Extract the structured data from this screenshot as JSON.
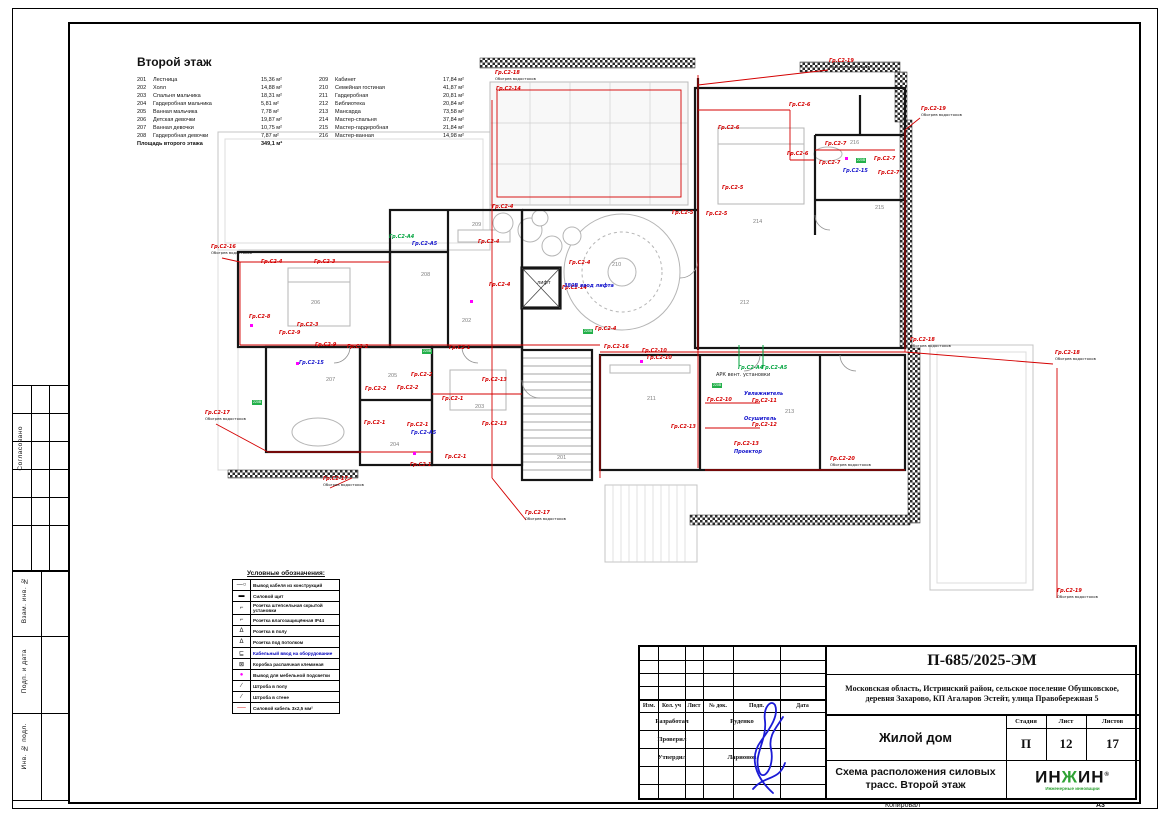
{
  "page": {
    "copied_label": "Копировал",
    "format_label": "А3"
  },
  "left_margin": {
    "approved": "Согласовано",
    "vzam": "Взам. инв. №",
    "podp": "Подп. и дата",
    "inv": "Инв. № подл."
  },
  "room_schedule": {
    "title": "Второй этаж",
    "col1": [
      {
        "num": "201",
        "name": "Лестница",
        "area": "15,36 м²"
      },
      {
        "num": "202",
        "name": "Холл",
        "area": "14,88 м²"
      },
      {
        "num": "203",
        "name": "Спальня мальчика",
        "area": "18,31 м²"
      },
      {
        "num": "204",
        "name": "Гардеробная мальчика",
        "area": "5,81 м²"
      },
      {
        "num": "205",
        "name": "Ванная мальчика",
        "area": "7,78 м²"
      },
      {
        "num": "206",
        "name": "Детская девочки",
        "area": "19,87 м²"
      },
      {
        "num": "207",
        "name": "Ванная девочки",
        "area": "10,75 м²"
      },
      {
        "num": "208",
        "name": "Гардеробная девочки",
        "area": "7,87 м²"
      }
    ],
    "col2": [
      {
        "num": "209",
        "name": "Кабинет",
        "area": "17,84 м²"
      },
      {
        "num": "210",
        "name": "Семейная гостиная",
        "area": "41,87 м²"
      },
      {
        "num": "211",
        "name": "Гардеробная",
        "area": "20,81 м²"
      },
      {
        "num": "212",
        "name": "Библиотека",
        "area": "20,84 м²"
      },
      {
        "num": "213",
        "name": "Мансарда",
        "area": "73,58 м²"
      },
      {
        "num": "214",
        "name": "Мастер-спальня",
        "area": "37,84 м²"
      },
      {
        "num": "215",
        "name": "Мастер-гардеробная",
        "area": "21,84 м²"
      },
      {
        "num": "216",
        "name": "Мастер-ванная",
        "area": "14,98 м²"
      }
    ],
    "total_label": "Площадь второго этажа",
    "total_area": "349,1 м²"
  },
  "legend": {
    "title": "Условные обозначения:",
    "items": [
      {
        "symbol": "wire-exit",
        "label": "Вывод кабеля из конструкций"
      },
      {
        "symbol": "panel",
        "label": "Силовой щит"
      },
      {
        "symbol": "socket",
        "label": "Розетка штепсельная скрытой установки"
      },
      {
        "symbol": "socket-wet",
        "label": "Розетка влагозащищённая IP44"
      },
      {
        "symbol": "socket-floor",
        "label": "Розетка в полу"
      },
      {
        "symbol": "socket-ceiling",
        "label": "Розетка под потолком"
      },
      {
        "symbol": "equipment",
        "label": "Кабельный ввод на оборудование",
        "accent": "blue"
      },
      {
        "symbol": "junction",
        "label": "Коробка распаячная клеммная"
      },
      {
        "symbol": "furniture",
        "label": "Вывод для мебельной подсветки"
      },
      {
        "symbol": "chase-floor",
        "label": "Штроба в полу"
      },
      {
        "symbol": "chase-wall",
        "label": "Штроба в стене"
      },
      {
        "symbol": "cable",
        "label": "Силовой кабель 3х2,5 мм²"
      }
    ]
  },
  "title_block": {
    "doc_number": "П-685/2025-ЭМ",
    "address": "Московская область, Истринский район, сельское поселение Обушковское, деревня Захарово, КП Агаларов Эстейт, улица Правобережная 5",
    "object_name": "Жилой дом",
    "sheet_title": "Схема расположения силовых трасс. Второй этаж",
    "stage_label": "Стадия",
    "sheet_label": "Лист",
    "sheets_label": "Листов",
    "stage": "П",
    "sheet": "12",
    "sheets": "17",
    "header_cols": [
      "Изм.",
      "Кол. уч",
      "Лист",
      "№ док.",
      "Подп.",
      "Дата"
    ],
    "rows": [
      {
        "role": "Разработал",
        "name": "Руденко"
      },
      {
        "role": "Проверил",
        "name": ""
      },
      {
        "role": "Утвердил",
        "name": "Ларионов"
      }
    ],
    "logo_part1": "ИН",
    "logo_accent": "Ж",
    "logo_part2": "ИН",
    "logo_reg": "®",
    "logo_sub": "Инженерные инновации"
  },
  "plan": {
    "accent_colors": {
      "circuit": "#d40000",
      "device": "#1414cc",
      "auto": "#00a33e",
      "outlet_marker": "#ff00ff"
    },
    "rooms": [
      {
        "n": "201",
        "x": 357,
        "y": 405
      },
      {
        "n": "202",
        "x": 262,
        "y": 268
      },
      {
        "n": "203",
        "x": 275,
        "y": 354
      },
      {
        "n": "204",
        "x": 190,
        "y": 392
      },
      {
        "n": "205",
        "x": 188,
        "y": 323
      },
      {
        "n": "206",
        "x": 111,
        "y": 250
      },
      {
        "n": "207",
        "x": 126,
        "y": 327
      },
      {
        "n": "208",
        "x": 221,
        "y": 222
      },
      {
        "n": "209",
        "x": 272,
        "y": 172
      },
      {
        "n": "210",
        "x": 412,
        "y": 212
      },
      {
        "n": "211",
        "x": 447,
        "y": 346
      },
      {
        "n": "212",
        "x": 540,
        "y": 250
      },
      {
        "n": "213",
        "x": 585,
        "y": 359
      },
      {
        "n": "214",
        "x": 553,
        "y": 169
      },
      {
        "n": "215",
        "x": 675,
        "y": 155
      },
      {
        "n": "216",
        "x": 650,
        "y": 90
      }
    ],
    "labels": [
      {
        "x": 296,
        "y": 26,
        "t": "Гр.С2-18",
        "sub": "Обогрев водостоков"
      },
      {
        "x": 630,
        "y": 14,
        "t": "Гр.С2-19",
        "sub": "Обогрев водостоков"
      },
      {
        "x": 722,
        "y": 62,
        "t": "Гр.С2-19",
        "sub": "Обогрев водостоков"
      },
      {
        "x": 856,
        "y": 306,
        "t": "Гр.С2-18",
        "sub": "Обогрев водостоков"
      },
      {
        "x": 858,
        "y": 544,
        "t": "Гр.С2-19",
        "sub": "Обогрев водостоков"
      },
      {
        "x": 711,
        "y": 293,
        "t": "Гр.С2-18",
        "sub": "Обогрев водостоков"
      },
      {
        "x": 326,
        "y": 466,
        "t": "Гр.С2-17",
        "sub": "Обогрев водостоков"
      },
      {
        "x": 124,
        "y": 432,
        "t": "Гр.С2-17",
        "sub": "Обогрев водостоков"
      },
      {
        "x": 6,
        "y": 366,
        "t": "Гр.С2-17",
        "sub": "Обогрев водостоков"
      },
      {
        "x": 12,
        "y": 200,
        "t": "Гр.С2-16",
        "sub": "Обогрев водостоков"
      },
      {
        "x": 631,
        "y": 412,
        "t": "Гр.С2-20",
        "sub": "Обогрев водостоков"
      },
      {
        "x": 297,
        "y": 42,
        "t": "Гр.С2-14"
      },
      {
        "x": 62,
        "y": 215,
        "t": "Гр.С2-4"
      },
      {
        "x": 115,
        "y": 215,
        "t": "Гр.С2-3"
      },
      {
        "x": 50,
        "y": 270,
        "t": "Гр.С2-8"
      },
      {
        "x": 98,
        "y": 278,
        "t": "Гр.С2-3"
      },
      {
        "x": 116,
        "y": 298,
        "t": "Гр.С2-9"
      },
      {
        "x": 80,
        "y": 286,
        "t": "Гр.С2-9"
      },
      {
        "x": 148,
        "y": 300,
        "t": "Гр.С2-2"
      },
      {
        "x": 250,
        "y": 301,
        "t": "Гр.С2-1"
      },
      {
        "x": 166,
        "y": 342,
        "t": "Гр.С2-2"
      },
      {
        "x": 198,
        "y": 341,
        "t": "Гр.С2-2"
      },
      {
        "x": 212,
        "y": 328,
        "t": "Гр.С2-2"
      },
      {
        "x": 165,
        "y": 376,
        "t": "Гр.С2-1"
      },
      {
        "x": 208,
        "y": 378,
        "t": "Гр.С2-1"
      },
      {
        "x": 243,
        "y": 352,
        "t": "Гр.С2-1"
      },
      {
        "x": 283,
        "y": 333,
        "t": "Гр.С2-13"
      },
      {
        "x": 283,
        "y": 377,
        "t": "Гр.С2-13"
      },
      {
        "x": 246,
        "y": 410,
        "t": "Гр.С2-1"
      },
      {
        "x": 211,
        "y": 418,
        "t": "Гр.С2-1"
      },
      {
        "x": 293,
        "y": 160,
        "t": "Гр.С2-4"
      },
      {
        "x": 279,
        "y": 195,
        "t": "Гр.С2-4"
      },
      {
        "x": 290,
        "y": 238,
        "t": "Гр.С2-4"
      },
      {
        "x": 370,
        "y": 216,
        "t": "Гр.С2-4"
      },
      {
        "x": 363,
        "y": 241,
        "t": "Гр.С2-14"
      },
      {
        "x": 396,
        "y": 282,
        "t": "Гр.С2-4"
      },
      {
        "x": 405,
        "y": 300,
        "t": "Гр.С2-16"
      },
      {
        "x": 443,
        "y": 304,
        "t": "Гр.С2-10"
      },
      {
        "x": 473,
        "y": 166,
        "t": "Гр.С2-5"
      },
      {
        "x": 448,
        "y": 311,
        "t": "Гр.С2-10"
      },
      {
        "x": 508,
        "y": 353,
        "t": "Гр.С2-10"
      },
      {
        "x": 553,
        "y": 354,
        "t": "Гр.С2-11"
      },
      {
        "x": 553,
        "y": 378,
        "t": "Гр.С2-12"
      },
      {
        "x": 472,
        "y": 380,
        "t": "Гр.С2-13"
      },
      {
        "x": 535,
        "y": 397,
        "t": "Гр.С2-13"
      },
      {
        "x": 590,
        "y": 58,
        "t": "Гр.С2-6"
      },
      {
        "x": 519,
        "y": 81,
        "t": "Гр.С2-6"
      },
      {
        "x": 588,
        "y": 107,
        "t": "Гр.С2-6"
      },
      {
        "x": 626,
        "y": 97,
        "t": "Гр.С2-7"
      },
      {
        "x": 620,
        "y": 116,
        "t": "Гр.С2-7"
      },
      {
        "x": 675,
        "y": 112,
        "t": "Гр.С2-7"
      },
      {
        "x": 679,
        "y": 126,
        "t": "Гр.С2-7"
      },
      {
        "x": 523,
        "y": 141,
        "t": "Гр.С2-5"
      },
      {
        "x": 507,
        "y": 167,
        "t": "Гр.С2-5"
      },
      {
        "x": 644,
        "y": 124,
        "t": "Гр.С2-15",
        "c": "blue"
      },
      {
        "x": 212,
        "y": 386,
        "t": "Гр.С2-А5",
        "c": "blue"
      },
      {
        "x": 100,
        "y": 316,
        "t": "Гр.С2-15",
        "c": "blue"
      },
      {
        "x": 213,
        "y": 197,
        "t": "Гр.С2-А5",
        "c": "blue"
      },
      {
        "x": 545,
        "y": 347,
        "t": "Увлажнитель",
        "c": "blue"
      },
      {
        "x": 545,
        "y": 372,
        "t": "Осушитель",
        "c": "blue"
      },
      {
        "x": 535,
        "y": 405,
        "t": "Проектор",
        "c": "blue"
      },
      {
        "x": 365,
        "y": 239,
        "t": "380В ввод лифта",
        "c": "blue"
      },
      {
        "x": 539,
        "y": 321,
        "t": "Гр.С2-А4",
        "c": "green"
      },
      {
        "x": 563,
        "y": 321,
        "t": "Гр.С2-А5",
        "c": "green"
      },
      {
        "x": 190,
        "y": 190,
        "t": "Гр.С2-А4",
        "c": "green"
      },
      {
        "x": 338,
        "y": 236,
        "t": "лифт",
        "c": "black"
      },
      {
        "x": 517,
        "y": 328,
        "t": "АРК вент. установки",
        "c": "black"
      }
    ],
    "chips": [
      {
        "x": 52,
        "y": 350,
        "t": "220В"
      },
      {
        "x": 222,
        "y": 299,
        "t": "220В"
      },
      {
        "x": 656,
        "y": 108,
        "t": "220В"
      },
      {
        "x": 383,
        "y": 279,
        "t": "220В"
      },
      {
        "x": 512,
        "y": 333,
        "t": "220В"
      }
    ],
    "marks": [
      {
        "x": 50,
        "y": 274
      },
      {
        "x": 96,
        "y": 312
      },
      {
        "x": 645,
        "y": 107
      },
      {
        "x": 440,
        "y": 310
      },
      {
        "x": 213,
        "y": 402
      },
      {
        "x": 270,
        "y": 250
      }
    ]
  }
}
